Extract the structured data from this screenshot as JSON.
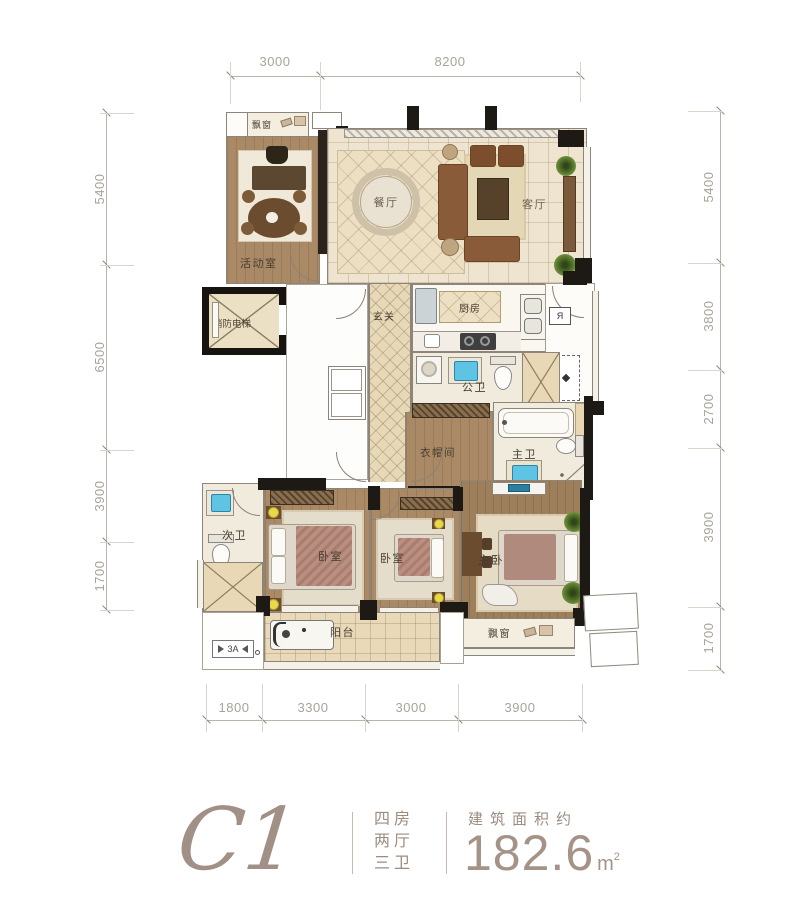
{
  "plan": {
    "rooms": {
      "bay_top": "飘窗",
      "activity": "活动室",
      "dining": "餐厅",
      "living": "客厅",
      "elevator": "消防电梯",
      "foyer": "玄关",
      "kitchen": "厨房",
      "public_bath": "公卫",
      "cloakroom": "衣帽间",
      "master_bath": "主卫",
      "second_bath": "次卫",
      "bedroom_a": "卧室",
      "bedroom_b": "卧室",
      "master_bedroom": "主卧",
      "balcony": "阳台",
      "bay_bottom": "飘窗"
    },
    "annotations": {
      "ac_platform": "3A"
    },
    "dimensions": {
      "top": [
        "3000",
        "8200"
      ],
      "bottom": [
        "1800",
        "3300",
        "3000",
        "3900"
      ],
      "left": [
        "5400",
        "6500",
        "3900",
        "1700"
      ],
      "right": [
        "5400",
        "3800",
        "2700",
        "3900",
        "1700"
      ]
    }
  },
  "footer": {
    "plan_code": "C1",
    "specs": [
      "四房",
      "两厅",
      "三卫"
    ],
    "area_label": "建筑面积约",
    "area_value": "182.6",
    "area_unit": "m",
    "area_exponent": "2"
  },
  "colors": {
    "wall": "#1d1a16",
    "wood_floor": "#aa8a66",
    "tile_floor": "#eee4cf",
    "brand_taupe": "#9c8c82",
    "fixture_blue": "#5fc4e4",
    "plant_green": "#6c8f3a"
  }
}
